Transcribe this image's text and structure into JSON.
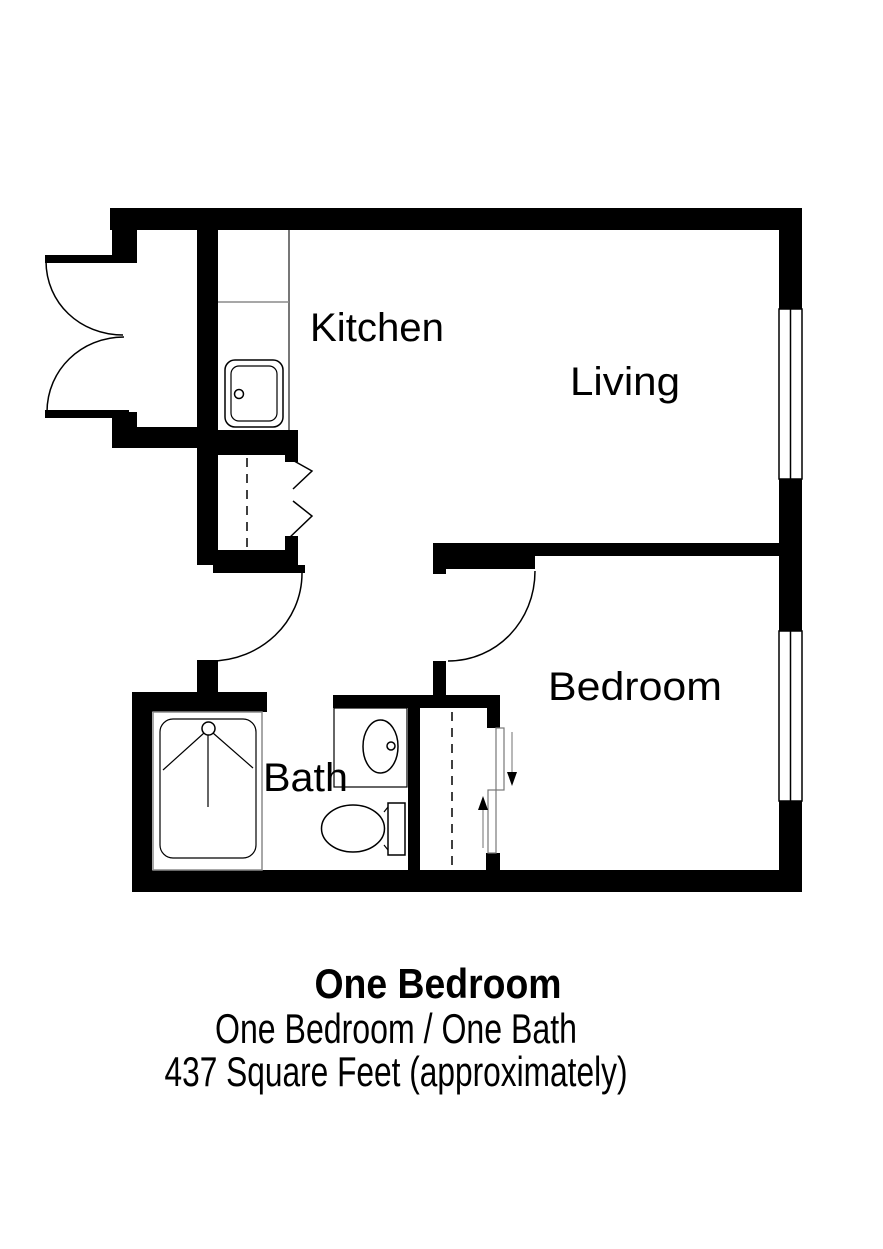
{
  "floorplan": {
    "rooms": {
      "kitchen": {
        "label": "Kitchen"
      },
      "living": {
        "label": "Living"
      },
      "bedroom": {
        "label": "Bedroom"
      },
      "bath": {
        "label": "Bath"
      }
    },
    "caption": {
      "title": "One Bedroom",
      "subtitle": "One Bedroom / One Bath",
      "area": "437 Square Feet (approximately)"
    },
    "colors": {
      "walls": "#000000",
      "background": "#ffffff",
      "fixture_lines": "#8a8a8a"
    },
    "fixtures": [
      "entry-double-door",
      "kitchen-sink",
      "kitchen-counter",
      "pantry-bifold-closet",
      "bath-door",
      "bedroom-door",
      "shower",
      "bath-sink",
      "toilet",
      "bedroom-sliding-closet",
      "living-window",
      "bedroom-window"
    ]
  }
}
